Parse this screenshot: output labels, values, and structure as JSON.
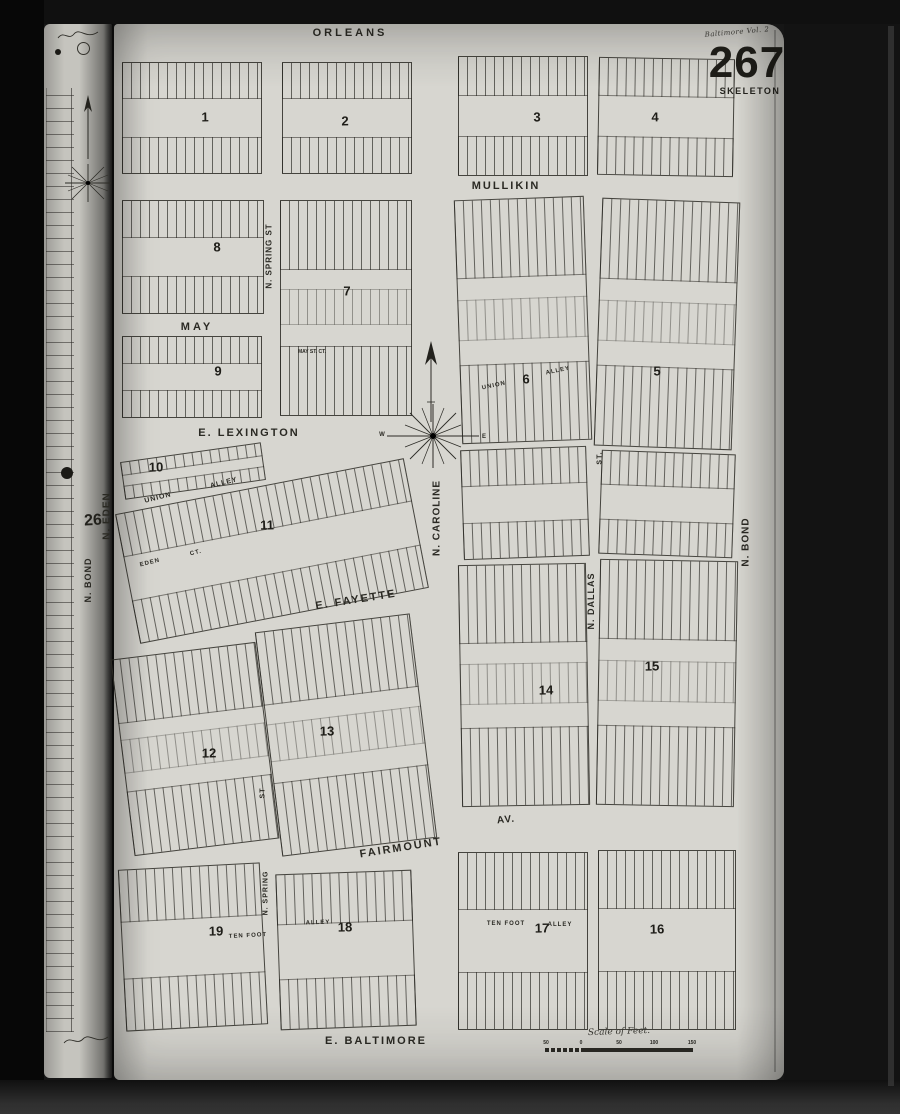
{
  "map": {
    "corner": {
      "note": "Baltimore Vol. 2",
      "page_number": "267",
      "page_label": "SKELETON"
    },
    "adjacent_page_number": "26",
    "compass": {
      "west": "W",
      "east": "E"
    },
    "scale": {
      "ticks": [
        {
          "t": "50",
          "x": 546
        },
        {
          "t": "0",
          "x": 581
        },
        {
          "t": "50",
          "x": 619
        },
        {
          "t": "100",
          "x": 654
        },
        {
          "t": "150",
          "x": 692
        }
      ]
    },
    "labels": [
      {
        "t": "ORLEANS",
        "x": 350,
        "y": 33,
        "s": 11,
        "ls": 3,
        "r": 0
      },
      {
        "t": "MULLIKIN",
        "x": 506,
        "y": 186,
        "s": 11,
        "ls": 2,
        "r": 0
      },
      {
        "t": "MAY",
        "x": 197,
        "y": 327,
        "s": 11,
        "ls": 3,
        "r": 0
      },
      {
        "t": "E. LEXINGTON",
        "x": 249,
        "y": 433,
        "s": 11,
        "ls": 2,
        "r": 0
      },
      {
        "t": "E. FAYETTE",
        "x": 356,
        "y": 600,
        "s": 11,
        "ls": 2,
        "r": -9
      },
      {
        "t": "FAIRMOUNT",
        "x": 401,
        "y": 848,
        "s": 11,
        "ls": 2,
        "r": -9
      },
      {
        "t": "AV.",
        "x": 506,
        "y": 820,
        "s": 10,
        "ls": 1,
        "r": -6
      },
      {
        "t": "E. BALTIMORE",
        "x": 376,
        "y": 1041,
        "s": 11,
        "ls": 2,
        "r": 0
      },
      {
        "t": "UNION",
        "x": 158,
        "y": 498,
        "s": 7,
        "ls": 1,
        "r": -14
      },
      {
        "t": "ALLEY",
        "x": 224,
        "y": 483,
        "s": 7,
        "ls": 1,
        "r": -14
      },
      {
        "t": "EDEN",
        "x": 150,
        "y": 563,
        "s": 6,
        "ls": 1,
        "r": -14
      },
      {
        "t": "CT.",
        "x": 196,
        "y": 553,
        "s": 6,
        "ls": 1,
        "r": -14
      },
      {
        "t": "UNION",
        "x": 494,
        "y": 386,
        "s": 6,
        "ls": 1,
        "r": -12
      },
      {
        "t": "ALLEY",
        "x": 558,
        "y": 371,
        "s": 6,
        "ls": 1,
        "r": -12
      },
      {
        "t": "MAY ST. CT.",
        "x": 312,
        "y": 352,
        "s": 5,
        "ls": 0,
        "r": 0
      },
      {
        "t": "TEN FOOT",
        "x": 248,
        "y": 936,
        "s": 6,
        "ls": 1,
        "r": -3
      },
      {
        "t": "ALLEY",
        "x": 318,
        "y": 923,
        "s": 6,
        "ls": 1,
        "r": -2
      },
      {
        "t": "TEN FOOT",
        "x": 506,
        "y": 924,
        "s": 6,
        "ls": 1,
        "r": 0
      },
      {
        "t": "ALLEY",
        "x": 560,
        "y": 925,
        "s": 6,
        "ls": 1,
        "r": 0
      },
      {
        "t": "Scale of Feet.",
        "x": 619,
        "y": 1032,
        "s": 9,
        "ls": 0,
        "r": -2,
        "serif": true
      },
      {
        "t": "N. SPRING ST",
        "x": 269,
        "y": 256,
        "s": 8,
        "ls": 1,
        "r": -90
      },
      {
        "t": "N. CAROLINE",
        "x": 437,
        "y": 518,
        "s": 10,
        "ls": 1,
        "r": -90
      },
      {
        "t": "N. DALLAS",
        "x": 591,
        "y": 601,
        "s": 9,
        "ls": 1,
        "r": -90
      },
      {
        "t": "N. BOND",
        "x": 746,
        "y": 542,
        "s": 10,
        "ls": 1,
        "r": -90
      },
      {
        "t": "N. EDEN",
        "x": 107,
        "y": 516,
        "s": 10,
        "ls": 1,
        "r": -90
      },
      {
        "t": "N. BOND",
        "x": 88,
        "y": 580,
        "s": 9,
        "ls": 1,
        "r": -90
      },
      {
        "t": "ST.",
        "x": 600,
        "y": 458,
        "s": 7,
        "ls": 1,
        "r": -90
      },
      {
        "t": "ST",
        "x": 263,
        "y": 793,
        "s": 7,
        "ls": 1,
        "r": -90
      },
      {
        "t": "N. SPRING",
        "x": 266,
        "y": 893,
        "s": 7,
        "ls": 1,
        "r": -90
      }
    ],
    "block_numbers": [
      {
        "n": "1",
        "x": 205,
        "y": 117
      },
      {
        "n": "2",
        "x": 345,
        "y": 121
      },
      {
        "n": "3",
        "x": 537,
        "y": 117
      },
      {
        "n": "4",
        "x": 655,
        "y": 117
      },
      {
        "n": "8",
        "x": 217,
        "y": 247
      },
      {
        "n": "7",
        "x": 347,
        "y": 291
      },
      {
        "n": "9",
        "x": 218,
        "y": 371
      },
      {
        "n": "6",
        "x": 526,
        "y": 379
      },
      {
        "n": "5",
        "x": 657,
        "y": 371
      },
      {
        "n": "10",
        "x": 156,
        "y": 467
      },
      {
        "n": "11",
        "x": 267,
        "y": 525
      },
      {
        "n": "12",
        "x": 209,
        "y": 753
      },
      {
        "n": "13",
        "x": 327,
        "y": 731
      },
      {
        "n": "14",
        "x": 546,
        "y": 690
      },
      {
        "n": "15",
        "x": 652,
        "y": 666
      },
      {
        "n": "19",
        "x": 216,
        "y": 931
      },
      {
        "n": "18",
        "x": 345,
        "y": 927
      },
      {
        "n": "17",
        "x": 542,
        "y": 928
      },
      {
        "n": "16",
        "x": 657,
        "y": 929
      }
    ],
    "blocks": [
      {
        "n": "1",
        "x": 122,
        "y": 62,
        "w": 138,
        "h": 110,
        "r": 0
      },
      {
        "n": "2",
        "x": 282,
        "y": 62,
        "w": 128,
        "h": 110,
        "r": 0
      },
      {
        "n": "3",
        "x": 458,
        "y": 56,
        "w": 128,
        "h": 118,
        "r": 0
      },
      {
        "n": "4",
        "x": 598,
        "y": 58,
        "w": 134,
        "h": 116,
        "r": 1
      },
      {
        "n": "8",
        "x": 122,
        "y": 200,
        "w": 140,
        "h": 112,
        "r": 0
      },
      {
        "n": "7",
        "x": 280,
        "y": 200,
        "w": 130,
        "h": 214,
        "r": 0
      },
      {
        "n": "6",
        "x": 458,
        "y": 198,
        "w": 128,
        "h": 242,
        "r": -2
      },
      {
        "n": "5",
        "x": 598,
        "y": 200,
        "w": 136,
        "h": 246,
        "r": 2
      },
      {
        "n": "9",
        "x": 122,
        "y": 336,
        "w": 138,
        "h": 80,
        "r": 0
      },
      {
        "n": "10",
        "x": 122,
        "y": 452,
        "w": 140,
        "h": 36,
        "r": -8
      },
      {
        "n": "11",
        "x": 125,
        "y": 485,
        "w": 292,
        "h": 130,
        "r": -11
      },
      {
        "n": "",
        "x": 462,
        "y": 448,
        "w": 124,
        "h": 108,
        "r": -2
      },
      {
        "n": "",
        "x": 600,
        "y": 452,
        "w": 132,
        "h": 102,
        "r": 2
      },
      {
        "n": "12",
        "x": 122,
        "y": 650,
        "w": 144,
        "h": 196,
        "r": -7
      },
      {
        "n": "13",
        "x": 268,
        "y": 622,
        "w": 154,
        "h": 224,
        "r": -7
      },
      {
        "n": "14",
        "x": 460,
        "y": 564,
        "w": 126,
        "h": 240,
        "r": -1
      },
      {
        "n": "15",
        "x": 598,
        "y": 560,
        "w": 136,
        "h": 244,
        "r": 1
      },
      {
        "n": "19",
        "x": 122,
        "y": 866,
        "w": 140,
        "h": 160,
        "r": -3
      },
      {
        "n": "18",
        "x": 278,
        "y": 872,
        "w": 134,
        "h": 154,
        "r": -2
      },
      {
        "n": "17",
        "x": 458,
        "y": 852,
        "w": 128,
        "h": 176,
        "r": 0
      },
      {
        "n": "16",
        "x": 598,
        "y": 850,
        "w": 136,
        "h": 178,
        "r": 0
      }
    ]
  }
}
